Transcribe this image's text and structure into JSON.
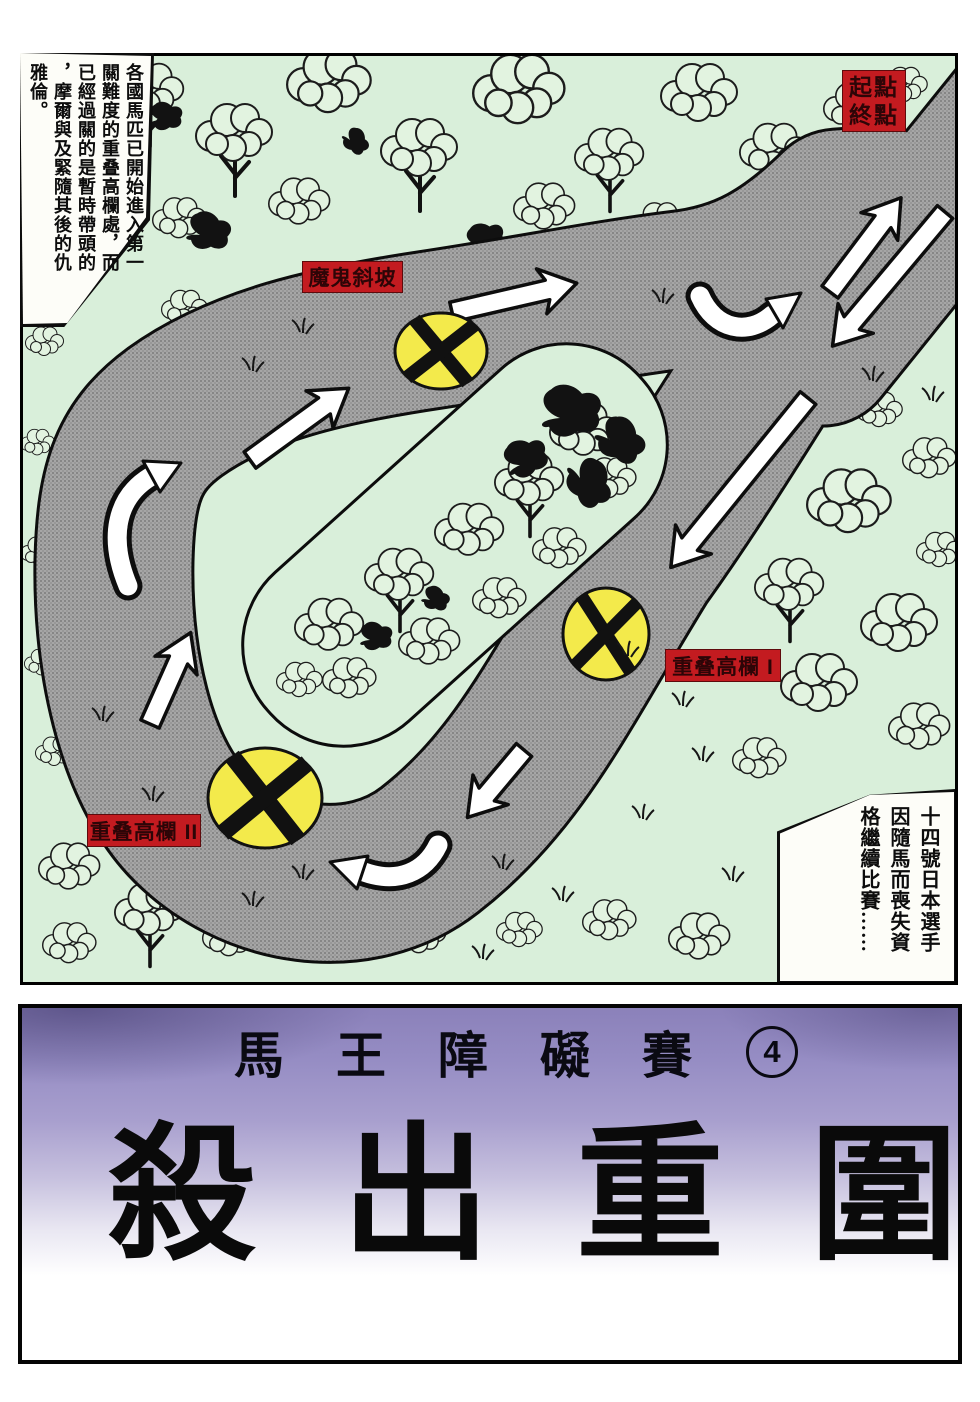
{
  "comic": {
    "narration_top_left": {
      "columns": [
        "各國馬匹已開始進入第一",
        "關難度的重叠高欄處，而",
        "已經過關的是暫時帶頭的",
        "，摩爾與及緊隨其後的仇",
        "雅倫。"
      ]
    },
    "narration_bottom_right": {
      "columns": [
        "十四號日本選手",
        "因隨馬而喪失資",
        "格繼續比賽……"
      ]
    },
    "map_labels": {
      "start_finish_line1": "起點",
      "start_finish_line2": "終點",
      "devil_slope": "魔鬼斜坡",
      "hurdle_1": "重叠高欄 I",
      "hurdle_2": "重叠高欄 II"
    },
    "title_block": {
      "series_title": "馬王障礙賽",
      "episode_number": "4",
      "main_title": "殺出重圍"
    }
  },
  "colors": {
    "label_red": "#c31b20",
    "obstacle_yellow": "#f3ea4b",
    "road_gray": "#a6a6a6",
    "road_dot": "#6f6f6f",
    "grass_green": "#d9efda",
    "foliage_green": "#e2f3e0",
    "banner_purple": "#8f86c0",
    "ink": "#111111"
  }
}
